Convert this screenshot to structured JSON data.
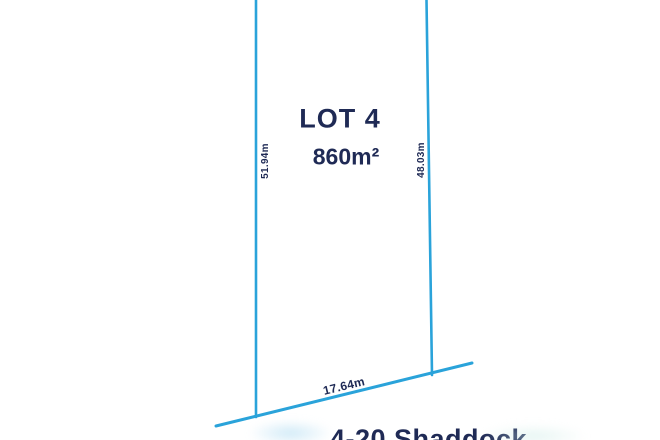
{
  "diagram": {
    "lot_label": "LOT 4",
    "area_label": "860m²",
    "dimensions": {
      "left_side": "51.94m",
      "right_side": "48.03m",
      "frontage": "17.64m"
    },
    "address_clipped": "4-20 Shaddock",
    "colors": {
      "boundary_line": "#2aa3da",
      "text_navy": "#1f2a55"
    }
  }
}
